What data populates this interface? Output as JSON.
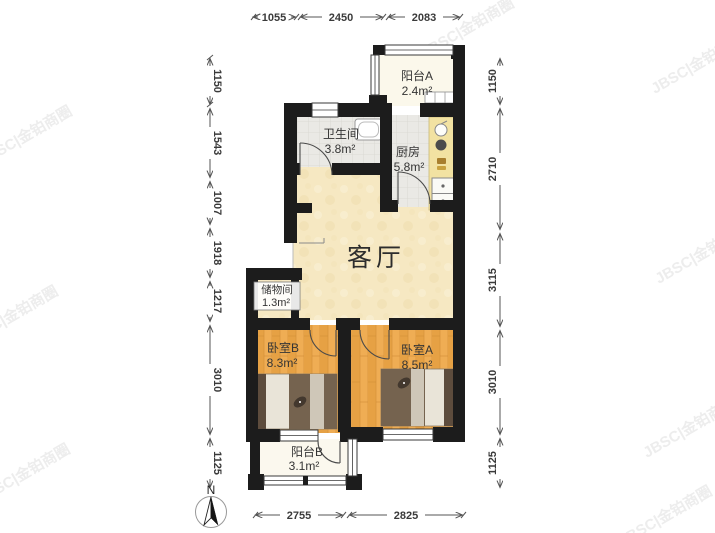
{
  "colors": {
    "wall": "#1c1c1c",
    "wood_floor": "#edaa50",
    "beige_floor": "#f6e8c2",
    "tile_floor": "#eae9e5",
    "balcony_floor": "#fbf8eb",
    "counter": "#f2e2a2",
    "dim_text": "#3a3a3a",
    "watermark": "#ededed"
  },
  "rooms": {
    "balcony_a": {
      "name": "阳台A",
      "area": "2.4m²"
    },
    "bathroom": {
      "name": "卫生间",
      "area": "3.8m²"
    },
    "kitchen": {
      "name": "厨房",
      "area": "5.8m²"
    },
    "living": {
      "name": "客厅"
    },
    "storage": {
      "name": "储物间",
      "area": "1.3m²"
    },
    "bedroom_b": {
      "name": "卧室B",
      "area": "8.3m²"
    },
    "bedroom_a": {
      "name": "卧室A",
      "area": "8.5m²"
    },
    "balcony_b": {
      "name": "阳台B",
      "area": "3.1m²"
    }
  },
  "dimensions": {
    "top": [
      "1055",
      "2450",
      "2083"
    ],
    "bottom": [
      "2755",
      "2825"
    ],
    "left": [
      "1150",
      "1543",
      "1007",
      "1918",
      "1217",
      "3010",
      "1125"
    ],
    "right": [
      "1150",
      "2710",
      "3115",
      "3010",
      "1125"
    ]
  },
  "compass": {
    "label": "N"
  },
  "watermark": {
    "text": "JBSC|金铂商圈"
  }
}
